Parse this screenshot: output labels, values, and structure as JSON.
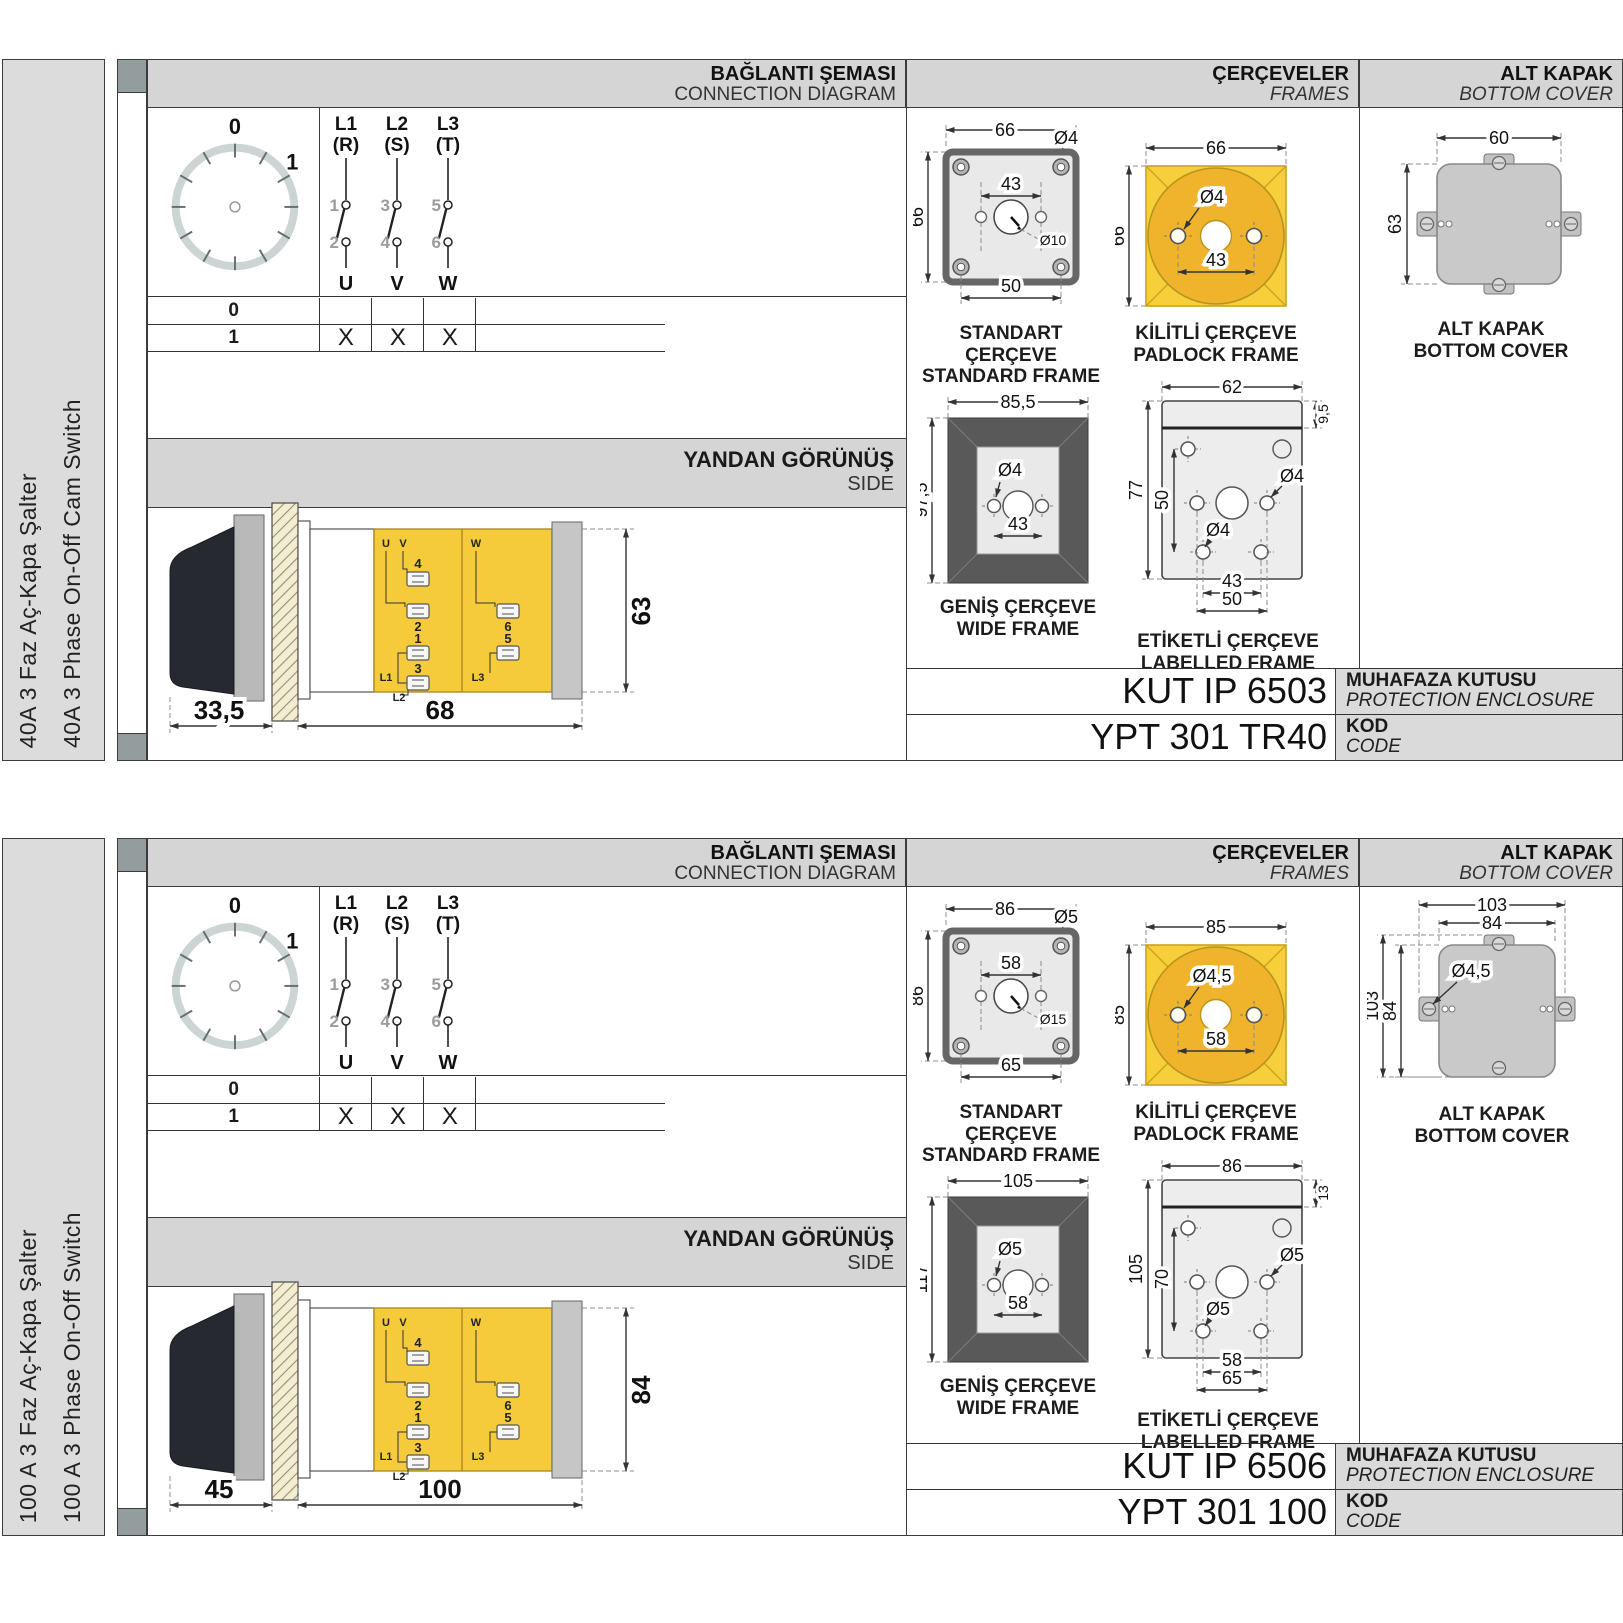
{
  "colors": {
    "yellow": "#F5CB3B",
    "yellow_circle": "#EFB42C",
    "frame_dark": "#595959",
    "band_gray": "#D5D5D5",
    "cover_gray": "#C9C9C9",
    "sidebar_gray": "#DCDCDC"
  },
  "sections": [
    {
      "sidebar_title_tr": "40A 3 Faz Aç-Kapa Şalter",
      "sidebar_title_en": "40A 3 Phase On-Off Cam Switch",
      "headers": {
        "diagram_tr": "BAĞLANTI ŞEMASI",
        "diagram_en": "CONNECTION DIAGRAM",
        "frames_tr": "ÇERÇEVELER",
        "frames_en": "FRAMES",
        "cover_tr": "ALT KAPAK",
        "cover_en": "BOTTOM COVER"
      },
      "dial": {
        "pos0": "0",
        "pos1": "1"
      },
      "phases": {
        "p1": {
          "l": "L1",
          "s": "(R)",
          "a": "1",
          "b": "2",
          "o": "U"
        },
        "p2": {
          "l": "L2",
          "s": "(S)",
          "a": "3",
          "b": "4",
          "o": "V"
        },
        "p3": {
          "l": "L3",
          "s": "(T)",
          "a": "5",
          "b": "6",
          "o": "W"
        }
      },
      "table": {
        "r0": {
          "pos": "0",
          "u": "",
          "v": "",
          "w": ""
        },
        "r1": {
          "pos": "1",
          "u": "X",
          "v": "X",
          "w": "X"
        }
      },
      "side": {
        "title_tr": "YANDAN GÖRÜNÜŞ",
        "title_en": "SIDE",
        "dim_handle": "33,5",
        "dim_body": "68",
        "dim_height": "63",
        "labels": {
          "u": "U",
          "v": "V",
          "w": "W",
          "n4": "4",
          "n2": "2",
          "n1": "1",
          "n3": "3",
          "n6": "6",
          "n5": "5",
          "l1": "L1",
          "l2": "L2",
          "l3": "L3"
        }
      },
      "frames": {
        "standard": {
          "cap_tr": "STANDART ÇERÇEVE",
          "cap_en": "STANDARD FRAME",
          "w": "66",
          "h": "66",
          "hole": "Ø4",
          "span": "43",
          "center": "Ø10",
          "bottom": "50"
        },
        "padlock": {
          "cap_tr": "KİLİTLİ ÇERÇEVE",
          "cap_en": "PADLOCK FRAME",
          "w": "66",
          "h": "66",
          "hole": "Ø4",
          "span": "43"
        },
        "wide": {
          "cap_tr": "GENİŞ ÇERÇEVE",
          "cap_en": "WIDE FRAME",
          "w": "85,5",
          "h": "97,5",
          "hole": "Ø4",
          "span": "43"
        },
        "labelled": {
          "cap_tr": "ETİKETLİ ÇERÇEVE",
          "cap_en": "LABELLED FRAME",
          "w": "62",
          "strip": "9,5",
          "h": "77",
          "inner_h": "50",
          "hole1": "Ø4",
          "hole2": "Ø4",
          "span1": "43",
          "span2": "50"
        }
      },
      "cover": {
        "cap_tr": "ALT KAPAK",
        "cap_en": "BOTTOM COVER",
        "w": "60",
        "h": "63"
      },
      "codes": {
        "enclosure": "KUT IP 6503",
        "enclosure_tr": "MUHAFAZA KUTUSU",
        "enclosure_en": "PROTECTION ENCLOSURE",
        "code": "YPT 301 TR40",
        "code_tr": "KOD",
        "code_en": "CODE"
      }
    },
    {
      "sidebar_title_tr": "100 A 3 Faz Aç-Kapa Şalter",
      "sidebar_title_en": "100 A 3 Phase On-Off Switch",
      "headers": {
        "diagram_tr": "BAĞLANTI ŞEMASI",
        "diagram_en": "CONNECTION DIAGRAM",
        "frames_tr": "ÇERÇEVELER",
        "frames_en": "FRAMES",
        "cover_tr": "ALT KAPAK",
        "cover_en": "BOTTOM COVER"
      },
      "dial": {
        "pos0": "0",
        "pos1": "1"
      },
      "phases": {
        "p1": {
          "l": "L1",
          "s": "(R)",
          "a": "1",
          "b": "2",
          "o": "U"
        },
        "p2": {
          "l": "L2",
          "s": "(S)",
          "a": "3",
          "b": "4",
          "o": "V"
        },
        "p3": {
          "l": "L3",
          "s": "(T)",
          "a": "5",
          "b": "6",
          "o": "W"
        }
      },
      "table": {
        "r0": {
          "pos": "0",
          "u": "",
          "v": "",
          "w": ""
        },
        "r1": {
          "pos": "1",
          "u": "X",
          "v": "X",
          "w": "X"
        }
      },
      "side": {
        "title_tr": "YANDAN GÖRÜNÜŞ",
        "title_en": "SIDE",
        "dim_handle": "45",
        "dim_body": "100",
        "dim_height": "84",
        "labels": {
          "u": "U",
          "v": "V",
          "w": "W",
          "n4": "4",
          "n2": "2",
          "n1": "1",
          "n3": "3",
          "n6": "6",
          "n5": "5",
          "l1": "L1",
          "l2": "L2",
          "l3": "L3"
        }
      },
      "frames": {
        "standard": {
          "cap_tr": "STANDART ÇERÇEVE",
          "cap_en": "STANDARD FRAME",
          "w": "86",
          "h": "86",
          "hole": "Ø5",
          "span": "58",
          "center": "Ø15",
          "bottom": "65"
        },
        "padlock": {
          "cap_tr": "KİLİTLİ ÇERÇEVE",
          "cap_en": "PADLOCK FRAME",
          "w": "85",
          "h": "85",
          "hole": "Ø4,5",
          "span": "58"
        },
        "wide": {
          "cap_tr": "GENİŞ ÇERÇEVE",
          "cap_en": "WIDE FRAME",
          "w": "105",
          "h": "117",
          "hole": "Ø5",
          "span": "58"
        },
        "labelled": {
          "cap_tr": "ETİKETLİ ÇERÇEVE",
          "cap_en": "LABELLED FRAME",
          "w": "86",
          "strip": "13",
          "h": "105",
          "inner_h": "70",
          "hole1": "Ø5",
          "hole2": "Ø5",
          "span1": "58",
          "span2": "65"
        }
      },
      "cover": {
        "cap_tr": "ALT KAPAK",
        "cap_en": "BOTTOM COVER",
        "w_outer": "103",
        "w_inner": "84",
        "h_outer": "103",
        "h_inner": "84",
        "hole": "Ø4,5"
      },
      "codes": {
        "enclosure": "KUT IP 6506",
        "enclosure_tr": "MUHAFAZA KUTUSU",
        "enclosure_en": "PROTECTION ENCLOSURE",
        "code": "YPT 301 100",
        "code_tr": "KOD",
        "code_en": "CODE"
      }
    }
  ]
}
